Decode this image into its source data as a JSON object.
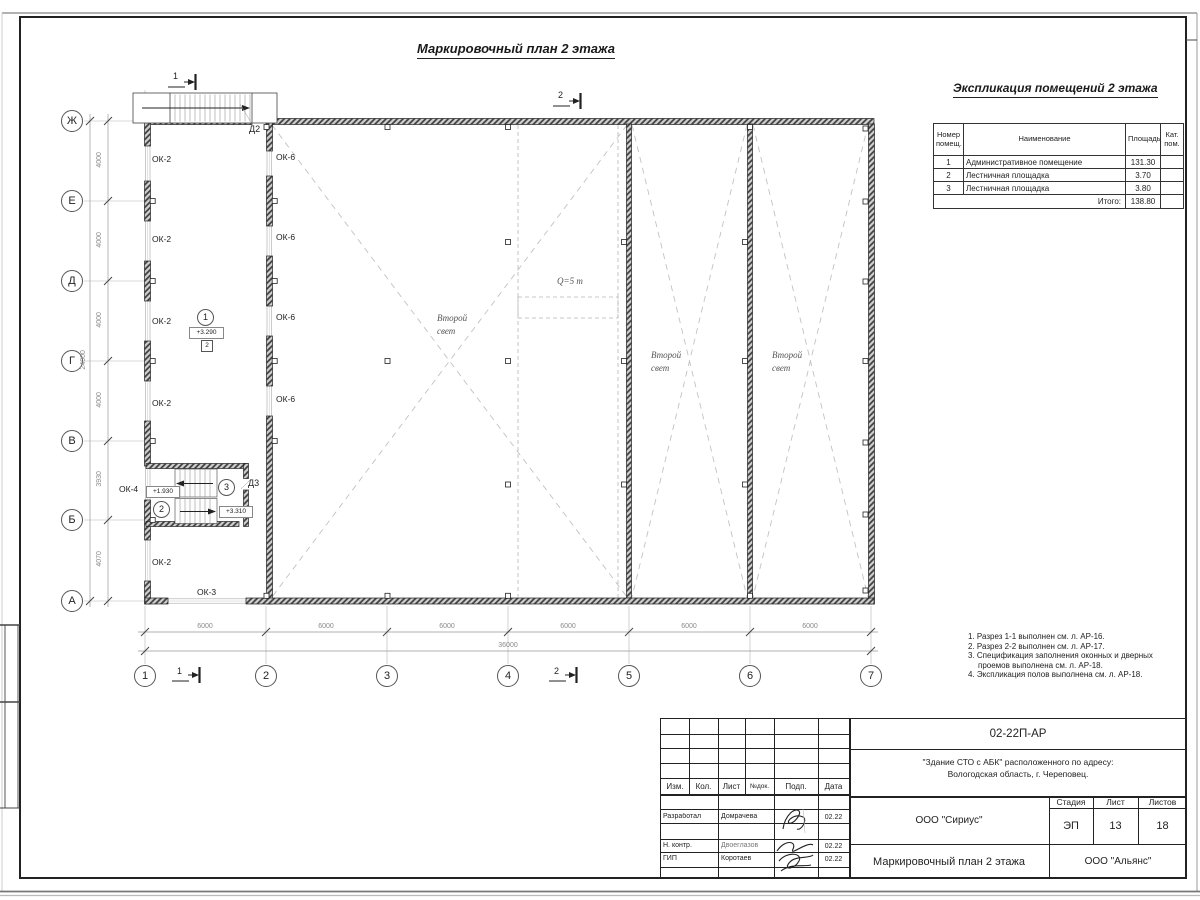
{
  "title": "Маркировочный план 2 этажа",
  "expl": {
    "title": "Экспликация помещений 2 этажа",
    "h_num": "Номер помещ.",
    "h_name": "Наименование",
    "h_area": "Площадь",
    "h_cat": "Кат. пом.",
    "rows": [
      {
        "num": "1",
        "name": "Административное помещение",
        "area": "131.30",
        "cat": ""
      },
      {
        "num": "2",
        "name": "Лестничная площадка",
        "area": "3.70",
        "cat": ""
      },
      {
        "num": "3",
        "name": "Лестничная площадка",
        "area": "3.80",
        "cat": ""
      }
    ],
    "total_label": "Итого:",
    "total": "138.80"
  },
  "plan": {
    "axes_rows": [
      "Ж",
      "Е",
      "Д",
      "Г",
      "В",
      "Б",
      "А"
    ],
    "axes_cols": [
      "1",
      "2",
      "3",
      "4",
      "5",
      "6",
      "7"
    ],
    "dims_bottom": [
      "6000",
      "6000",
      "6000",
      "6000",
      "6000",
      "6000"
    ],
    "dim_total_bottom": "36000",
    "dims_left": [
      "4000",
      "4000",
      "4000",
      "4000",
      "3930",
      "4070"
    ],
    "dim_total_left": "24000",
    "labels": {
      "ok2": "ОК-2",
      "ok3": "ОК-3",
      "ok4": "ОК-4",
      "ok6": "ОК-6",
      "d2": "Д2",
      "d3": "Д3"
    },
    "crane": "Q=5 т",
    "void1": "Второй",
    "void2": "свет",
    "rooms": {
      "r1": "1",
      "r1_elev": "+3.290",
      "r1_type": "2",
      "r2": "2",
      "r2_elev": "+1.930",
      "r3": "3",
      "r3_elev": "+3.310"
    },
    "sections": {
      "s1": "1",
      "s2": "2"
    }
  },
  "notes": {
    "n1": "1. Разрез 1-1 выполнен см. л. АР-16.",
    "n2": "2. Разрез 2-2 выполнен см. л. АР-17.",
    "n3a": "3. Спецификация заполнения оконных и дверных",
    "n3b": "проемов выполнена см. л. АР-18.",
    "n4": "4. Экспликация полов выполнена см. л. АР-18."
  },
  "stamp": {
    "doc_no": "02-22П-АР",
    "addr1": "\"Здание СТО с АБК\" расположенного по адресу:",
    "addr2": "Вологодская область, г. Череповец.",
    "org": "ООО \"Сириус\"",
    "stage_h": "Стадия",
    "sheet_h": "Лист",
    "sheets_h": "Листов",
    "stage": "ЭП",
    "sheet": "13",
    "sheets": "18",
    "drawing_title": "Маркировочный план 2 этажа",
    "org2": "ООО \"Альянс\"",
    "c_izm": "Изм.",
    "c_kol": "Кол.",
    "c_list": "Лист",
    "c_doc": "№док.",
    "c_sign": "Подп.",
    "c_date": "Дата",
    "r1_role": "Разработал",
    "r1_name": "Домрачева",
    "r1_date": "02.22",
    "r2_role": "Н. контр.",
    "r2_name": "Двоеглазов",
    "r2_date": "02.22",
    "r3_role": "ГИП",
    "r3_name": "Коротаев",
    "r3_date": "02.22"
  }
}
